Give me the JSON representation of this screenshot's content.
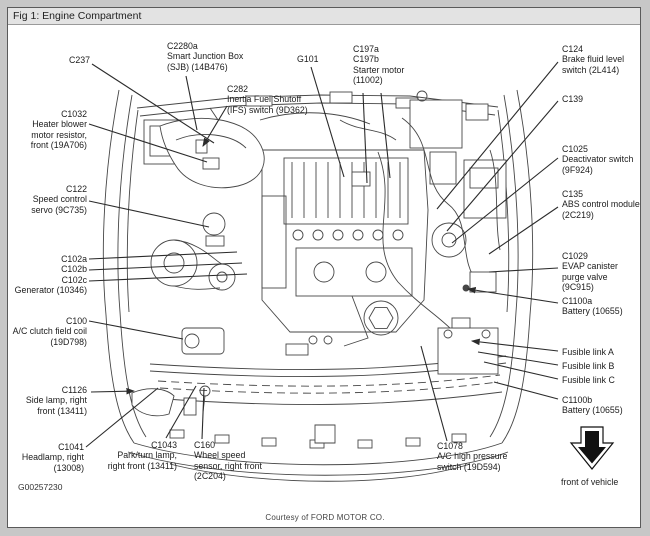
{
  "figure": {
    "title": "Fig 1: Engine Compartment"
  },
  "footer": {
    "figure_number": "G00257230",
    "courtesy": "Courtesy of FORD MOTOR CO."
  },
  "colors": {
    "page_bg": "#c7c7c7",
    "panel_bg": "#ffffff",
    "border": "#5a5a5a",
    "titlebar_bg": "#e3e3e3",
    "text": "#1c1c1c",
    "line": "#474747"
  },
  "labels": [
    {
      "id": "c237",
      "x": 90,
      "y": 55,
      "align": "right",
      "lines": [
        "C237"
      ]
    },
    {
      "id": "c2280a",
      "x": 167,
      "y": 41,
      "align": "left",
      "lines": [
        "C2280a",
        "Smart Junction Box",
        "(SJB) (14B476)"
      ]
    },
    {
      "id": "c282",
      "x": 227,
      "y": 84,
      "align": "left",
      "lines": [
        "C282",
        "Inertia Fuel Shutoff",
        "(IFS) switch (9D362)"
      ]
    },
    {
      "id": "g101",
      "x": 297,
      "y": 54,
      "align": "left",
      "lines": [
        "G101"
      ]
    },
    {
      "id": "c197",
      "x": 353,
      "y": 44,
      "align": "left",
      "lines": [
        "C197a",
        "C197b",
        "Starter motor",
        "(11002)"
      ]
    },
    {
      "id": "c1032",
      "x": 87,
      "y": 109,
      "align": "right",
      "lines": [
        "C1032",
        "Heater blower",
        "motor resistor,",
        "front (19A706)"
      ]
    },
    {
      "id": "c122",
      "x": 87,
      "y": 184,
      "align": "right",
      "lines": [
        "C122",
        "Speed control",
        "servo (9C735)"
      ]
    },
    {
      "id": "c102",
      "x": 87,
      "y": 254,
      "align": "right",
      "lines": [
        "C102a",
        "C102b",
        "C102c",
        "Generator (10346)"
      ]
    },
    {
      "id": "c100",
      "x": 87,
      "y": 316,
      "align": "right",
      "lines": [
        "C100",
        "A/C clutch field coil",
        "(19D798)"
      ]
    },
    {
      "id": "c1126",
      "x": 87,
      "y": 385,
      "align": "right",
      "lines": [
        "C1126",
        "Side lamp, right",
        "front (13411)"
      ]
    },
    {
      "id": "c1041",
      "x": 84,
      "y": 442,
      "align": "right",
      "lines": [
        "C1041",
        "Headlamp, right",
        "(13008)"
      ]
    },
    {
      "id": "c1043",
      "x": 177,
      "y": 440,
      "align": "right",
      "lines": [
        "C1043",
        "Park/turn lamp,",
        "right front (13411)"
      ]
    },
    {
      "id": "c160",
      "x": 194,
      "y": 440,
      "align": "left",
      "lines": [
        "C160",
        "Wheel speed",
        "sensor, right front",
        "(2C204)"
      ]
    },
    {
      "id": "c1078",
      "x": 437,
      "y": 441,
      "align": "left",
      "lines": [
        "C1078",
        "A/C high pressure",
        "switch (19D594)"
      ]
    },
    {
      "id": "c124",
      "x": 562,
      "y": 44,
      "align": "left",
      "lines": [
        "C124",
        "Brake fluid level",
        "switch (2L414)"
      ]
    },
    {
      "id": "c139",
      "x": 562,
      "y": 94,
      "align": "left",
      "lines": [
        "C139"
      ]
    },
    {
      "id": "c1025",
      "x": 562,
      "y": 144,
      "align": "left",
      "lines": [
        "C1025",
        "Deactivator switch",
        "(9F924)"
      ]
    },
    {
      "id": "c135",
      "x": 562,
      "y": 189,
      "align": "left",
      "lines": [
        "C135",
        "ABS control module",
        "(2C219)"
      ]
    },
    {
      "id": "c1029",
      "x": 562,
      "y": 251,
      "align": "left",
      "lines": [
        "C1029",
        "EVAP canister",
        "purge valve",
        "(9C915)"
      ]
    },
    {
      "id": "c1100a",
      "x": 562,
      "y": 296,
      "align": "left",
      "lines": [
        "C1100a",
        "Battery (10655)"
      ]
    },
    {
      "id": "fusible-a",
      "x": 562,
      "y": 347,
      "align": "left",
      "lines": [
        "Fusible link A"
      ]
    },
    {
      "id": "fusible-b",
      "x": 562,
      "y": 361,
      "align": "left",
      "lines": [
        "Fusible link B"
      ]
    },
    {
      "id": "fusible-c",
      "x": 562,
      "y": 375,
      "align": "left",
      "lines": [
        "Fusible link C"
      ]
    },
    {
      "id": "c1100b",
      "x": 562,
      "y": 395,
      "align": "left",
      "lines": [
        "C1100b",
        "Battery (10655)"
      ]
    },
    {
      "id": "front-of-vehicle",
      "x": 561,
      "y": 477,
      "align": "left",
      "lines": [
        "front of vehicle"
      ]
    }
  ],
  "leaders": [
    {
      "id": "c237",
      "from": [
        92,
        64
      ],
      "to": [
        214,
        143
      ],
      "arrow": false
    },
    {
      "id": "c2280a",
      "from": [
        186,
        76
      ],
      "to": [
        197,
        130
      ],
      "arrow": false
    },
    {
      "id": "c282",
      "from": [
        227,
        106
      ],
      "to": [
        203,
        146
      ],
      "arrow": true
    },
    {
      "id": "g101",
      "from": [
        311,
        67
      ],
      "to": [
        344,
        177
      ],
      "arrow": false
    },
    {
      "id": "c197a",
      "from": [
        363,
        93
      ],
      "to": [
        367,
        183
      ],
      "arrow": false
    },
    {
      "id": "c197b",
      "from": [
        381,
        93
      ],
      "to": [
        390,
        178
      ],
      "arrow": false
    },
    {
      "id": "c124",
      "from": [
        558,
        62
      ],
      "to": [
        437,
        209
      ],
      "arrow": false
    },
    {
      "id": "c139",
      "from": [
        558,
        101
      ],
      "to": [
        447,
        231
      ],
      "arrow": false
    },
    {
      "id": "c1025",
      "from": [
        558,
        158
      ],
      "to": [
        452,
        243
      ],
      "arrow": false
    },
    {
      "id": "c135",
      "from": [
        558,
        207
      ],
      "to": [
        489,
        254
      ],
      "arrow": false
    },
    {
      "id": "c1029",
      "from": [
        558,
        268
      ],
      "to": [
        489,
        272
      ],
      "arrow": false
    },
    {
      "id": "c1100a",
      "from": [
        558,
        303
      ],
      "to": [
        468,
        289
      ],
      "arrow": true
    },
    {
      "id": "fusible-a",
      "from": [
        558,
        351
      ],
      "to": [
        472,
        341
      ],
      "arrow": true
    },
    {
      "id": "fusible-b",
      "from": [
        558,
        365
      ],
      "to": [
        478,
        352
      ],
      "arrow": false
    },
    {
      "id": "fusible-c",
      "from": [
        558,
        379
      ],
      "to": [
        484,
        362
      ],
      "arrow": false
    },
    {
      "id": "c1100b",
      "from": [
        558,
        399
      ],
      "to": [
        494,
        382
      ],
      "arrow": false
    },
    {
      "id": "c1078",
      "from": [
        447,
        441
      ],
      "to": [
        421,
        346
      ],
      "arrow": false
    },
    {
      "id": "c160",
      "from": [
        202,
        439
      ],
      "to": [
        204,
        388
      ],
      "arrow": false
    },
    {
      "id": "c1043",
      "from": [
        166,
        438
      ],
      "to": [
        196,
        386
      ],
      "arrow": false
    },
    {
      "id": "c1041",
      "from": [
        86,
        447
      ],
      "to": [
        158,
        388
      ],
      "arrow": false
    },
    {
      "id": "c1126",
      "from": [
        91,
        392
      ],
      "to": [
        134,
        391
      ],
      "arrow": true
    },
    {
      "id": "c100",
      "from": [
        89,
        321
      ],
      "to": [
        183,
        339
      ],
      "arrow": false
    },
    {
      "id": "c102a",
      "from": [
        89,
        259
      ],
      "to": [
        237,
        252
      ],
      "arrow": false
    },
    {
      "id": "c102b",
      "from": [
        89,
        270
      ],
      "to": [
        242,
        263
      ],
      "arrow": false
    },
    {
      "id": "c102c",
      "from": [
        89,
        281
      ],
      "to": [
        247,
        274
      ],
      "arrow": false
    },
    {
      "id": "c122",
      "from": [
        89,
        201
      ],
      "to": [
        209,
        227
      ],
      "arrow": false
    },
    {
      "id": "c1032",
      "from": [
        89,
        124
      ],
      "to": [
        207,
        162
      ],
      "arrow": false
    }
  ]
}
